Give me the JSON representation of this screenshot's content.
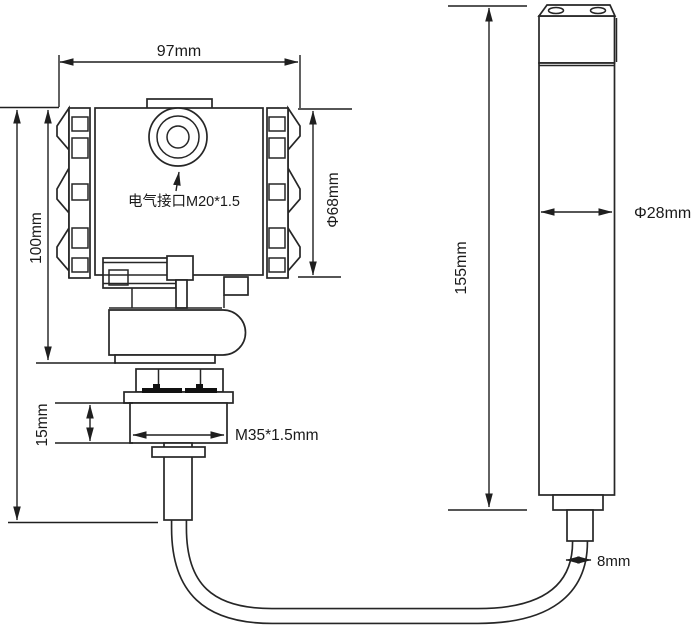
{
  "colors": {
    "background": "#ffffff",
    "line": "#262626",
    "dimension_line": "#1f1f1f",
    "text": "#1a1a1a",
    "gasket_fill": "#111111"
  },
  "transmitter": {
    "width_dim": "97mm",
    "body_height_dim": "100mm",
    "end_cap_diameter_dim": "Φ68mm",
    "electrical_port_label": "电气接口M20*1.5",
    "thread_height_dim": "15mm",
    "thread_spec_label": "M35*1.5mm"
  },
  "probe": {
    "length_dim": "155mm",
    "diameter_dim": "Φ28mm",
    "cable_diameter_dim": "8mm"
  }
}
